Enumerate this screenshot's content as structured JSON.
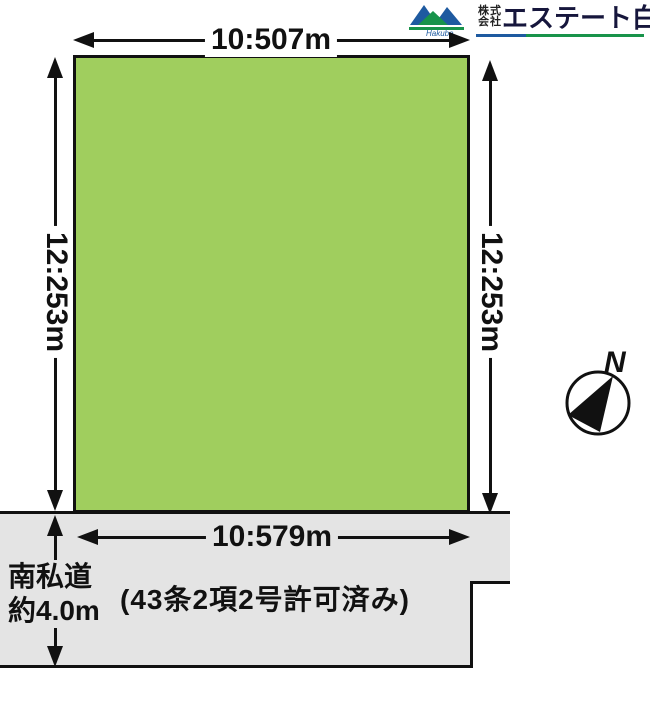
{
  "logo": {
    "company_prefix_line1": "株式",
    "company_prefix_line2": "会社",
    "company_name": "エステート白馬",
    "caption": "Hakuba"
  },
  "dimensions": {
    "top": "10:507m",
    "bottom": "10:579m",
    "left": "12:253m",
    "right": "12:253m"
  },
  "road": {
    "name": "南私道",
    "width": "約4.0m",
    "permit_note": "(43条2項2号許可済み)"
  },
  "compass": {
    "north_label": "N"
  },
  "colors": {
    "plot_green": "#a0ce5e",
    "road_gray": "#e4e4e4",
    "line_black": "#111111",
    "logo_blue": "#1e5aa0",
    "logo_green": "#18934a"
  }
}
